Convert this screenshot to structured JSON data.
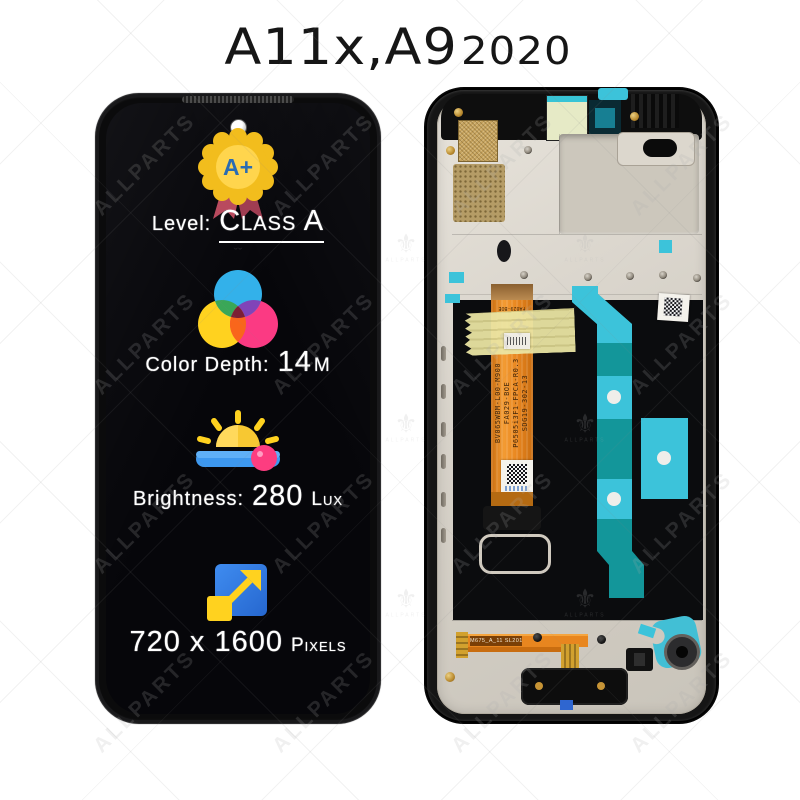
{
  "title": {
    "model": "A11x,A9",
    "year": "2020"
  },
  "watermark": {
    "text": "ALLPARTS",
    "logo_caption": "ALLPARTS"
  },
  "left_panel": {
    "grade_badge": "A+",
    "specs": [
      {
        "id": "level",
        "label": "Level:",
        "value": "Class A"
      },
      {
        "id": "color_depth",
        "label": "Color Depth:",
        "number": "14",
        "suffix": "m"
      },
      {
        "id": "brightness",
        "label": "Brightness:",
        "number": "280",
        "suffix": "Lux"
      },
      {
        "id": "resolution",
        "number": "720 x 1600",
        "suffix": "pixels"
      }
    ]
  },
  "right_panel": {
    "flex_label_lines": [
      "BV065WBM-L00-M900",
      "FA029-BOE",
      "P6505i3F1-FPCA-R0.3",
      "SDG19-302-13"
    ],
    "flex_top_label": "FA029-BOE",
    "bottom_flex_label": "M675_A_11 SL2012"
  },
  "colors": {
    "badge_gold": "#f6c51c",
    "badge_text_blue": "#2a6cb3",
    "ribbon_red": "#b94a5e",
    "icon_blue": "#2f7de5",
    "icon_yellow": "#ffd21f",
    "icon_pink": "#fb3a83",
    "tape_cyan": "#3cc3da",
    "strip_teal": "#13969a",
    "flex_orange": "#e8861f",
    "kapton_yellow": "#ebe5a4",
    "plate_silver": "#d7d2c9",
    "frame_black": "#151515"
  }
}
